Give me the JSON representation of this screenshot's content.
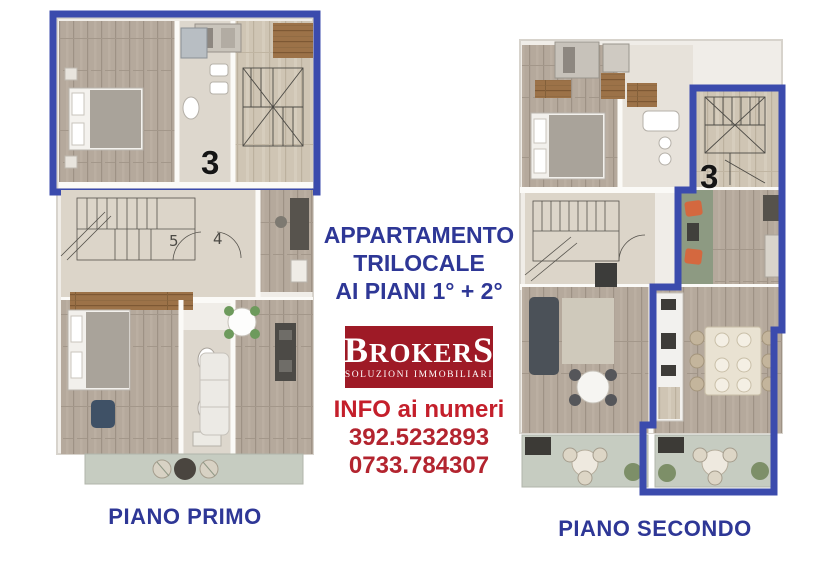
{
  "header": {
    "line1": "APPARTAMENTO",
    "line2": "TRILOCALE",
    "line3": "AI PIANI 1° + 2°"
  },
  "logo": {
    "brand_first": "B",
    "brand_middle": "ROKER",
    "brand_last": "S",
    "tagline": "SOLUZIONI IMMOBILIARI"
  },
  "contact": {
    "heading": "INFO ai numeri",
    "phones": [
      "392.5232893",
      "0733.784307"
    ]
  },
  "floor_plans": {
    "first": {
      "caption": "PIANO PRIMO",
      "unit_badge": "3",
      "door_numbers": [
        "5",
        "4"
      ]
    },
    "second": {
      "caption": "PIANO SECONDO",
      "unit_badge": "3"
    }
  },
  "colors": {
    "title_blue": "#2e3796",
    "outline_blue": "#3b4bad",
    "logo_red": "#9e1a26",
    "contact_red": "#c41f2b",
    "phone_red": "#b3242f",
    "unit_black": "#151515"
  }
}
